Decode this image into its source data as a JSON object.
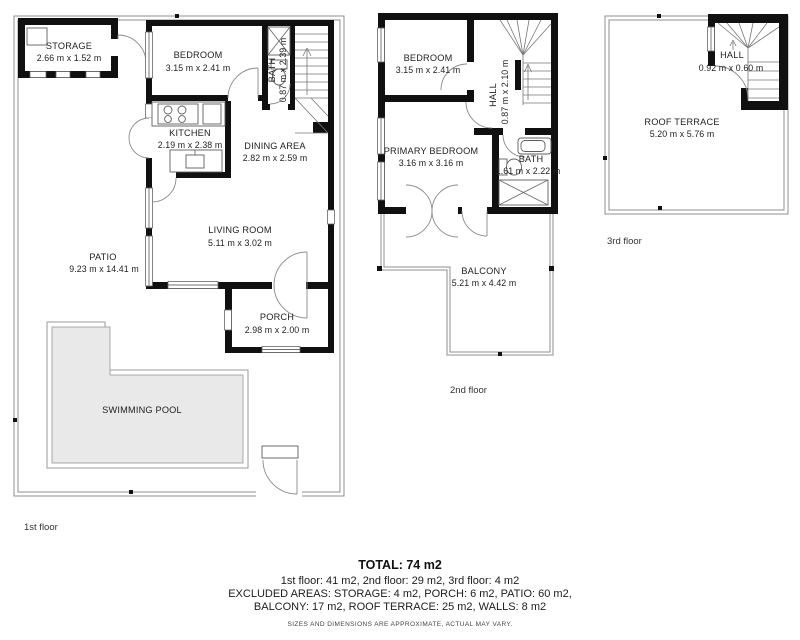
{
  "title": "House floor plan",
  "colors": {
    "wall": "#101010",
    "pool_fill": "#e9e9e9",
    "fence_line": "#8f8f8f",
    "text": "#222222"
  },
  "floors": {
    "f1": {
      "label": "1st floor",
      "rooms": {
        "storage": {
          "name": "STORAGE",
          "dims": "2.66 m x 1.52 m"
        },
        "bedroom": {
          "name": "BEDROOM",
          "dims": "3.15 m x 2.41 m"
        },
        "bath": {
          "name": "BATH",
          "dims": "0.87 m x 2.39 m"
        },
        "kitchen": {
          "name": "KITCHEN",
          "dims": "2.19 m x 2.38 m"
        },
        "dining": {
          "name": "DINING AREA",
          "dims": "2.82 m x 2.59 m"
        },
        "living": {
          "name": "LIVING ROOM",
          "dims": "5.11 m x 3.02 m"
        },
        "patio": {
          "name": "PATIO",
          "dims": "9.23 m x 14.41 m"
        },
        "porch": {
          "name": "PORCH",
          "dims": "2.98 m x 2.00 m"
        },
        "pool": {
          "name": "SWIMMING POOL"
        }
      }
    },
    "f2": {
      "label": "2nd floor",
      "rooms": {
        "bedroom": {
          "name": "BEDROOM",
          "dims": "3.15 m x 2.41 m"
        },
        "hall": {
          "name": "HALL",
          "dims": "0.87 m x 2.10 m"
        },
        "primary": {
          "name": "PRIMARY BEDROOM",
          "dims": "3.16 m x 3.16 m"
        },
        "bath": {
          "name": "BATH",
          "dims": "1.61 m x 2.22 m"
        },
        "balcony": {
          "name": "BALCONY",
          "dims": "5.21 m x 4.42 m"
        }
      }
    },
    "f3": {
      "label": "3rd floor",
      "rooms": {
        "hall": {
          "name": "HALL",
          "dims": "0.92 m x 0.60 m"
        },
        "terrace": {
          "name": "ROOF TERRACE",
          "dims": "5.20 m x 5.76 m"
        }
      }
    }
  },
  "summary": {
    "total": "TOTAL: 74 m2",
    "floors_line": "1st floor: 41 m2, 2nd floor: 29 m2, 3rd floor: 4 m2",
    "excluded_line1": "EXCLUDED AREAS: STORAGE: 4 m2, PORCH: 6 m2, PATIO: 60 m2,",
    "excluded_line2": "BALCONY: 17 m2, ROOF TERRACE: 25 m2, WALLS: 8 m2",
    "disclaimer": "SIZES AND DIMENSIONS ARE APPROXIMATE, ACTUAL MAY VARY."
  }
}
